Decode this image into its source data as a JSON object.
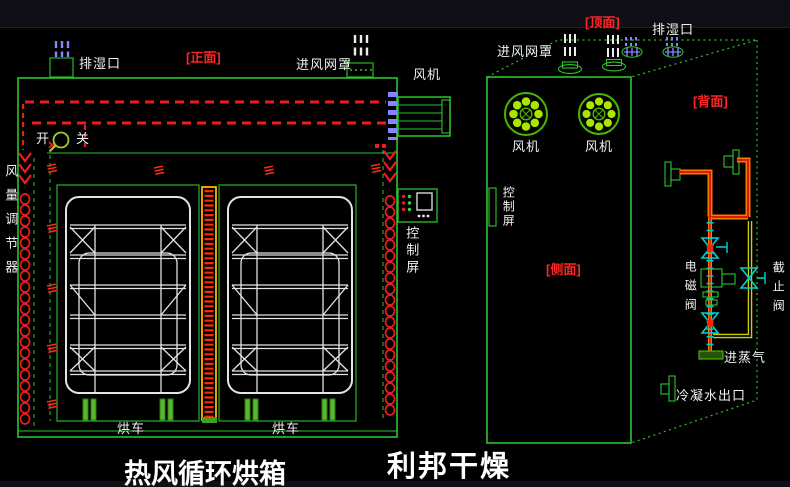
{
  "titles": {
    "product": "热风循环烘箱",
    "brand": "利邦干燥"
  },
  "front_view": {
    "view_label": "[正面]",
    "exhaust_port_label": "排湿口",
    "inlet_mesh_label": "进风网罩",
    "fan_label": "风机",
    "switch_on_label": "开",
    "switch_off_label": "关",
    "air_volume_regulator_label": "风量调节器",
    "control_panel_label": "控制屏",
    "trolley_labels": [
      "烘车",
      "烘车"
    ]
  },
  "perspective_view": {
    "top_view_label": "[顶面]",
    "side_view_label": "[侧面]",
    "back_view_label": "[背面]",
    "exhaust_port_label": "排湿口",
    "inlet_mesh_label": "进风网罩",
    "fan_labels": [
      "风机",
      "风机"
    ],
    "control_panel_label": "控制屏",
    "solenoid_valve_label": "电磁阀",
    "stop_valve_label": "截止阀",
    "steam_inlet_label": "进蒸气",
    "condensate_outlet_label": "冷凝水出口"
  },
  "icons": {
    "fan_wheel_icon": "green circle with 8 bright dots and cross hub",
    "switch_indicator_icon": "green ring with handle",
    "valve_icon": "cyan bowtie with red core",
    "stop_valve_icon": "cyan bowtie with T-handle",
    "heater_coil_icon": "vertical chain of red coils",
    "flow_mark_icon": "red triple wave",
    "vent_hatch_icon": "blue/white hatch bars"
  },
  "colors": {
    "background": "#000000",
    "cad_green": "#2cc42c",
    "dashed_red": "#ee1c1c",
    "heater_red": "#ff2a00",
    "divider_orange": "#ffb300",
    "pipe_orange": "#ff7700",
    "pipe_yellow": "#cfcf00",
    "valve_cyan": "#00d2d2",
    "hatch_blue": "#8585ff",
    "fan_dot_green": "#a8e800",
    "trolley_white": "#e4e4e4",
    "label_white": "#f0f0f0",
    "label_red": "#ff2525"
  }
}
